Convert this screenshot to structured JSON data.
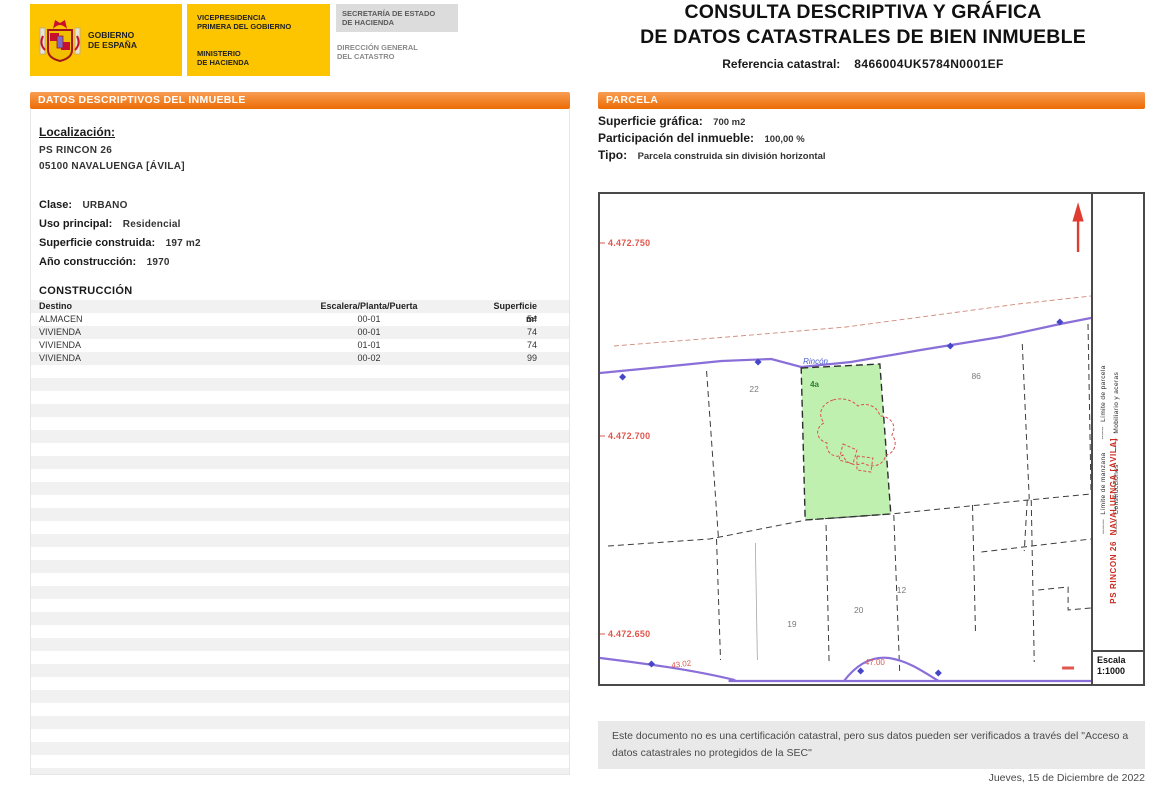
{
  "header": {
    "logo": {
      "gobierno_l1": "GOBIERNO",
      "gobierno_l2": "DE ESPAÑA",
      "vice_l1": "VICEPRESIDENCIA",
      "vice_l2": "PRIMERA DEL GOBIERNO",
      "min_l1": "MINISTERIO",
      "min_l2": "DE HACIENDA",
      "sec_l1": "SECRETARÍA DE ESTADO",
      "sec_l2": "DE HACIENDA",
      "dir_l1": "DIRECCIÓN GENERAL",
      "dir_l2": "DEL CATASTRO"
    },
    "title_line1": "CONSULTA DESCRIPTIVA Y GRÁFICA",
    "title_line2": "DE DATOS CATASTRALES DE BIEN INMUEBLE",
    "ref_label": "Referencia catastral:",
    "ref_value": "8466004UK5784N0001EF"
  },
  "left_panel": {
    "title": "DATOS DESCRIPTIVOS DEL INMUEBLE",
    "localizacion_label": "Localización:",
    "address_line1": "PS RINCON 26",
    "address_line2": "05100 NAVALUENGA [ÁVILA]",
    "fields": [
      {
        "label": "Clase:",
        "value": "URBANO"
      },
      {
        "label": "Uso principal:",
        "value": "Residencial"
      },
      {
        "label": "Superficie construida:",
        "value": "197 m2"
      },
      {
        "label": "Año construcción:",
        "value": "1970"
      }
    ],
    "construccion_title": "CONSTRUCCIÓN",
    "table": {
      "headers": [
        "Destino",
        "Escalera/Planta/Puerta",
        "Superficie m²"
      ],
      "rows": [
        [
          "ALMACEN",
          "00-01",
          "54"
        ],
        [
          "VIVIENDA",
          "00-01",
          "74"
        ],
        [
          "VIVIENDA",
          "01-01",
          "74"
        ],
        [
          "VIVIENDA",
          "00-02",
          "99"
        ]
      ]
    }
  },
  "right_panel": {
    "title": "PARCELA",
    "superficie_label": "Superficie gráfica:",
    "superficie_value": "700 m2",
    "participacion_label": "Participación del inmueble:",
    "participacion_value": "100,00 %",
    "tipo_label": "Tipo:",
    "tipo_value": "Parcela construida sin división horizontal",
    "map": {
      "coords": [
        "4.472.750",
        "4.472.700",
        "4.472.650"
      ],
      "street_label": "Rincón",
      "parcel_label": "4a",
      "numbers": {
        "n22": "22",
        "n86": "86",
        "n12": "12",
        "n19": "19",
        "n20": "20"
      },
      "road_numbers": {
        "r1": "43.02",
        "r2": "47.00"
      },
      "legend_col1": "───  Límite de manzana      ╌╌╌  Límite de parcela",
      "legend_col2": "───  Construcciones      ╌╌╌  Mobiliario y aceras",
      "red_side_text": "PS RINCON 26  NAVALUENGA [ÁVILA]",
      "escala_label": "Escala",
      "escala_value": "1:1000"
    },
    "disclaimer": "Este documento no es una certificación catastral, pero sus datos pueden ser verificados a través del \"Acceso a datos catastrales no protegidos de la SEC\"",
    "date": "Jueves, 15 de Diciembre de 2022"
  }
}
